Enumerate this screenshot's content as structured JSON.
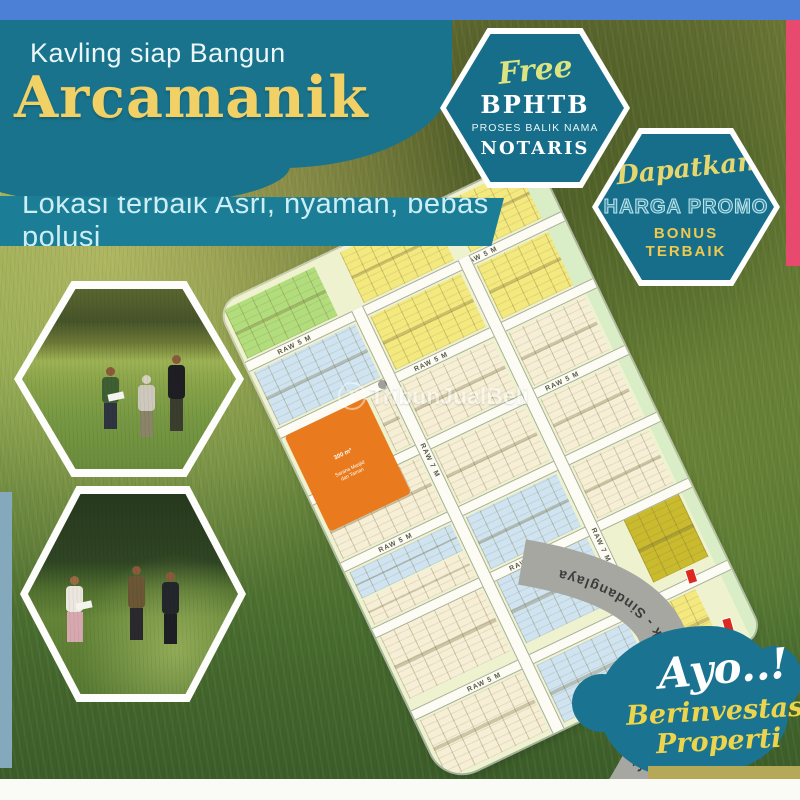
{
  "header": {
    "kicker": "Kavling siap Bangun",
    "title": "Arcamanik",
    "tagline": "Lokasi terbaik Asri, nyaman, bebas polusi"
  },
  "badge_free": {
    "script": "Free",
    "title": "BPHTB",
    "subtitle": "PROSES BALIK NAMA",
    "footer": "NOTARIS"
  },
  "badge_promo": {
    "script": "Dapatkan",
    "title": "HARGA PROMO",
    "line2": "BONUS",
    "line3": "TERBAIK"
  },
  "siteplan": {
    "road_small": "RAW 5 M",
    "road_large": "RAW 7 M",
    "main_road": "Jl. Raya Arcamanik - Sindanglaya",
    "facility": {
      "line1": "300 m²",
      "line2": "Sarana Masjid",
      "line3": "dan Taman"
    }
  },
  "cta": {
    "script": "Ayo..!",
    "line1": "Berinvestasi",
    "line2": "Properti"
  },
  "watermark": {
    "logo": "T",
    "text": "TribunJualBeli"
  },
  "colors": {
    "top_bar_blue": "#4b80d6",
    "teal": "#19738c",
    "headline_yellow": "#f1d066",
    "accent_pink": "#e84a6f",
    "map_yellow": "#f4e97e",
    "map_cream": "#f6efd6",
    "map_blue": "#cfe4f0",
    "map_lime": "#b2dd7d",
    "map_orange": "#e97b1e",
    "map_olive": "#c9ba2e",
    "road_gray": "#a7a7a2",
    "cloud_teal": "#1a7391"
  }
}
